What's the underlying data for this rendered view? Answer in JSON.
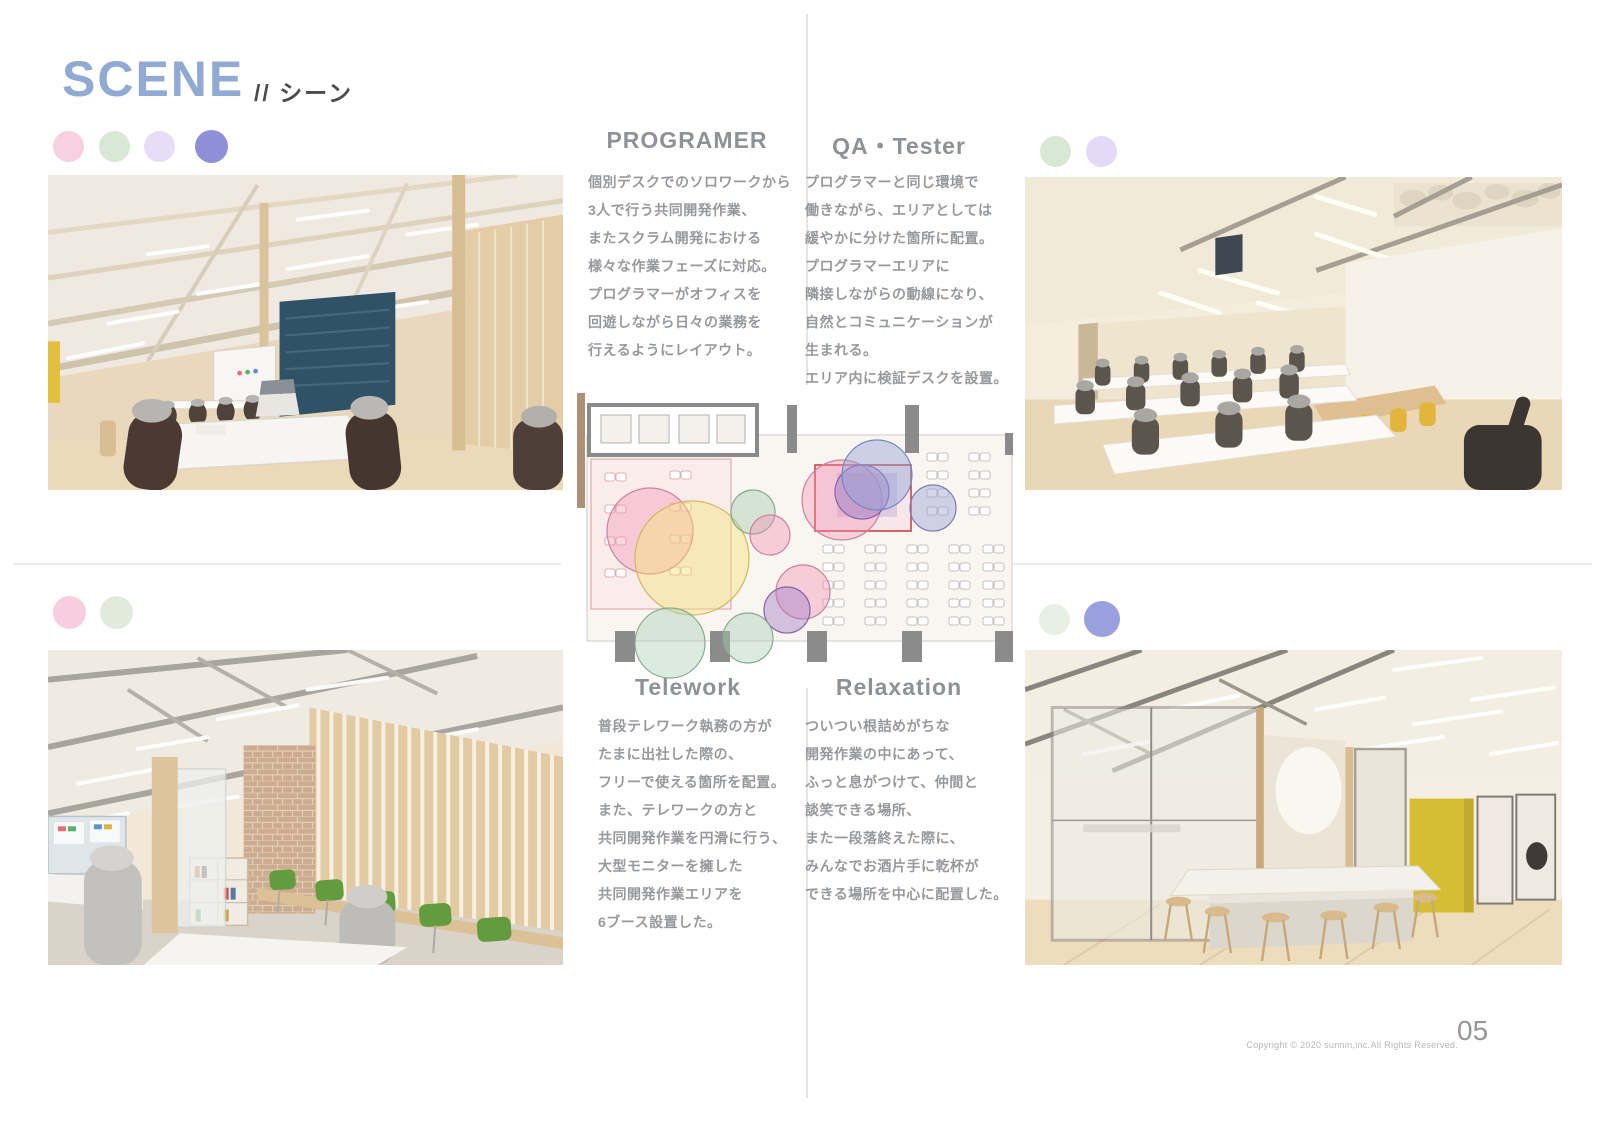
{
  "page": {
    "title": "SCENE",
    "subtitle": "// シーン",
    "page_number": "05",
    "copyright": "Copyright © 2020 sunnin,inc.All Rights Reserved."
  },
  "palette": {
    "title_blue": "#90aad3",
    "heading_gray": "#8e9296",
    "body_gray": "#96999c"
  },
  "legend": {
    "row_title": [
      "#f7d0e1",
      "#d9e7d6",
      "#e7ddf6",
      "#8d8fd9"
    ],
    "row_qa": [
      "#d9e8d5",
      "#e4d9f6"
    ],
    "row_telework": [
      "#f7cde0",
      "#e0ebdc"
    ],
    "row_relax": [
      "#e8efe5",
      "#9aa0de"
    ]
  },
  "sections": {
    "programer": {
      "title": "PROGRAMER",
      "lines": [
        "個別デスクでのソロワークから",
        "3人で行う共同開発作業、",
        "またスクラム開発における",
        "様々な作業フェーズに対応。",
        "プログラマーがオフィスを",
        "回遊しながら日々の業務を",
        "行えるようにレイアウト。"
      ]
    },
    "qa": {
      "title": "QA・Tester",
      "lines": [
        "プログラマーと同じ環境で",
        "働きながら、エリアとしては",
        "緩やかに分けた箇所に配置。",
        "プログラマーエリアに",
        "隣接しながらの動線になり、",
        "自然とコミュニケーションが",
        "生まれる。",
        "エリア内に検証デスクを設置。"
      ]
    },
    "telework": {
      "title": "Telework",
      "lines": [
        "普段テレワーク執務の方が",
        "たまに出社した際の、",
        "フリーで使える箇所を配置。",
        "また、テレワークの方と",
        "共同開発作業を円滑に行う、",
        "大型モニターを擁した",
        "共同開発作業エリアを",
        "6ブース設置した。"
      ]
    },
    "relaxation": {
      "title": "Relaxation",
      "lines": [
        "ついつい根詰めがちな",
        "開発作業の中にあって、",
        "ふっと息がつけて、仲間と",
        "談笑できる場所、",
        "また一段落終えた際に、",
        "みんなでお酒片手に乾杯が",
        "できる場所を中心に配置した。"
      ]
    }
  },
  "floor_plan": {
    "bubbles": [
      {
        "x": 75,
        "y": 138,
        "r": 43,
        "fill": "#f191b4",
        "opacity": 0.38,
        "stroke": "#cf7fa0"
      },
      {
        "x": 117,
        "y": 165,
        "r": 57,
        "fill": "#f3e27a",
        "opacity": 0.45,
        "stroke": "#cdbb5e"
      },
      {
        "x": 178,
        "y": 119,
        "r": 22,
        "fill": "#a9cfb4",
        "opacity": 0.45,
        "stroke": "#84ac90"
      },
      {
        "x": 195,
        "y": 142,
        "r": 20,
        "fill": "#f191b4",
        "opacity": 0.4,
        "stroke": "#cf7fa0"
      },
      {
        "x": 267,
        "y": 107,
        "r": 40,
        "fill": "#f191b4",
        "opacity": 0.38,
        "stroke": "#cf7fa0"
      },
      {
        "x": 287,
        "y": 99,
        "r": 27,
        "fill": "#a581c9",
        "opacity": 0.45,
        "stroke": "#8463a6"
      },
      {
        "x": 302,
        "y": 82,
        "r": 35,
        "fill": "#93a3d6",
        "opacity": 0.45,
        "stroke": "#7487bd"
      },
      {
        "x": 358,
        "y": 115,
        "r": 23,
        "fill": "#9a9ad2",
        "opacity": 0.42,
        "stroke": "#7c7cb5"
      },
      {
        "x": 228,
        "y": 199,
        "r": 27,
        "fill": "#f191b4",
        "opacity": 0.4,
        "stroke": "#cf7fa0"
      },
      {
        "x": 212,
        "y": 217,
        "r": 23,
        "fill": "#a581c9",
        "opacity": 0.45,
        "stroke": "#8463a6"
      },
      {
        "x": 95,
        "y": 250,
        "r": 35,
        "fill": "#a9cfb4",
        "opacity": 0.42,
        "stroke": "#84ac90"
      },
      {
        "x": 173,
        "y": 245,
        "r": 25,
        "fill": "#a9cfb4",
        "opacity": 0.42,
        "stroke": "#84ac90"
      }
    ]
  }
}
